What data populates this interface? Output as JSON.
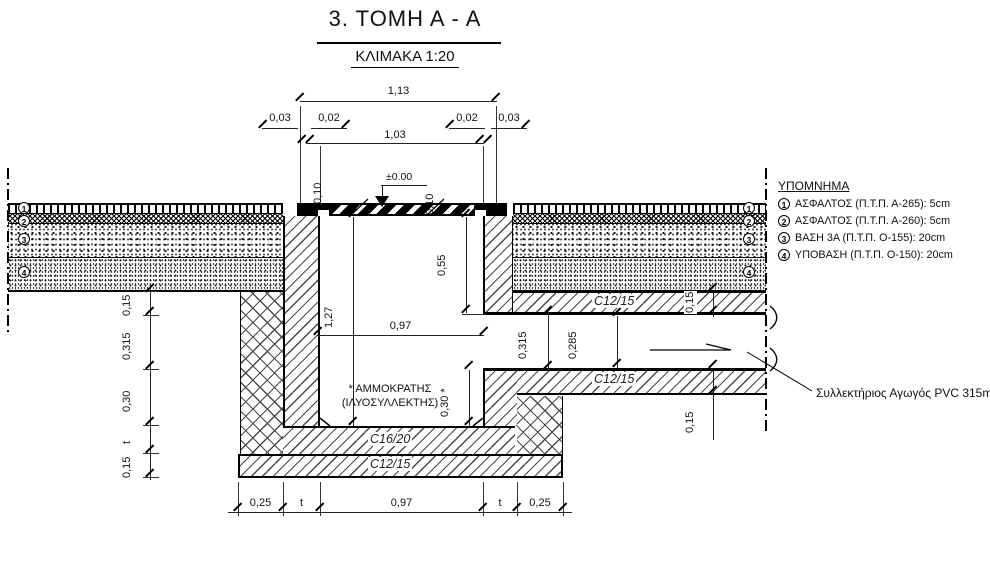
{
  "title": {
    "heading": "3.  ΤΟΜΗ  Α - Α",
    "scale": "ΚΛΙΜΑΚΑ 1:20"
  },
  "legend": {
    "title": "ΥΠΟΜΝΗΜΑ",
    "items": [
      {
        "num": "1",
        "text": "ΑΣΦΑΛΤΟΣ (Π.Τ.Π. Α-265): 5cm"
      },
      {
        "num": "2",
        "text": "ΑΣΦΑΛΤΟΣ (Π.Τ.Π. Α-260): 5cm"
      },
      {
        "num": "3",
        "text": "ΒΑΣΗ 3Α (Π.Τ.Π. Ο-155): 20cm"
      },
      {
        "num": "4",
        "text": "ΥΠΟΒΑΣΗ (Π.Τ.Π. Ο-150): 20cm"
      }
    ]
  },
  "layer_markers": {
    "left": [
      "1",
      "2",
      "3",
      "4"
    ],
    "right": [
      "1",
      "2",
      "3",
      "4"
    ]
  },
  "dims": {
    "total_width": "1,13",
    "edge_left": "0,03",
    "lip_left_top": "0,02",
    "clear_top": "1,03",
    "lip_right_top": "0,02",
    "edge_right": "0,03",
    "level": "±0.00",
    "wall_top_left": "0,10",
    "wall_top_right": "0,10",
    "upper_chamber": "0,55",
    "chamber_height": "1,27",
    "chamber_width": "0,97",
    "opening_height": "0,315",
    "pipe_height": "0,285",
    "upper_slab": "0,15",
    "lower_slab": "0,15",
    "floor_depth": "0,30 *",
    "left_chain": [
      "0,15",
      "0,315",
      "0,30",
      "t",
      "0,15"
    ],
    "bottom_chain": [
      "0,25",
      "t",
      "0,97",
      "t",
      "0,25"
    ]
  },
  "labels": {
    "note_line1": "* ΑΜΜΟΚΡΑΤΗΣ",
    "note_line2": "(ΙΛΥΟΣΥΛΛΕΚΤΗΣ)",
    "concrete_base": "C16/20",
    "concrete_lean": "C12/15",
    "concrete_slab_upper": "C12/15",
    "concrete_slab_lower": "C12/15",
    "pipe_callout": "Συλλεκτήριος Αγωγός PVC 315mm"
  },
  "colors": {
    "ink": "#111111",
    "line": "#000000",
    "hatch": "#4a4a4a"
  }
}
